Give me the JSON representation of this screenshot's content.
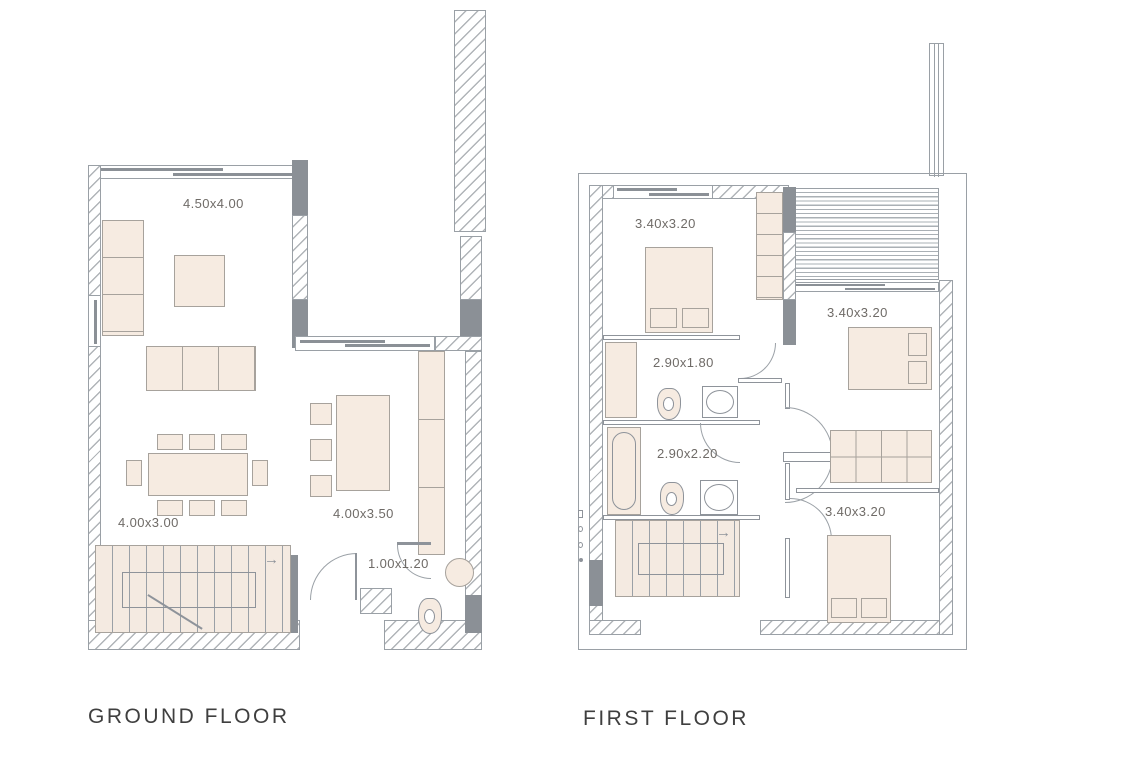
{
  "ground": {
    "title": "GROUND FLOOR",
    "living_dims": "4.50x4.00",
    "dining_dims": "4.00x3.00",
    "kitchen_dims": "4.00x3.50",
    "wc_dims": "1.00x1.20"
  },
  "first": {
    "title": "FIRST FLOOR",
    "bedroom1_dims": "3.40x3.20",
    "bathroom1_dims": "2.90x1.80",
    "bedroom2_dims": "3.40x3.20",
    "bathroom2_dims": "2.90x2.20",
    "bedroom3_dims": "3.40x3.20"
  },
  "symbols": {
    "stairs_arrow": "→"
  },
  "colors": {
    "background": "#ffffff",
    "wall": "#8b9096",
    "outline": "#9aa0a6",
    "hatch_line": "#b0b4b8",
    "furniture_fill": "#f6ebe1",
    "stairs_fill": "#f4eae1",
    "label_text": "#6f6b67",
    "title_text": "#3f3f3f"
  }
}
